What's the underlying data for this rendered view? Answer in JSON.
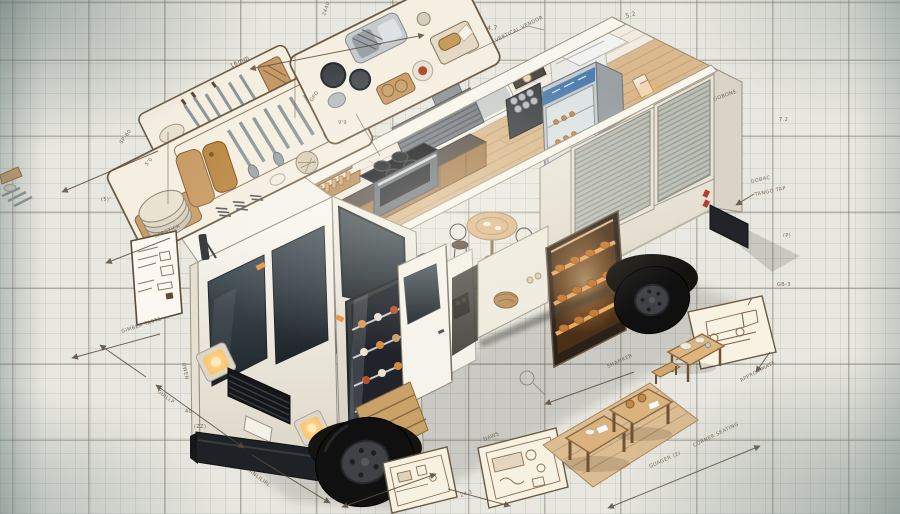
{
  "scene": {
    "subject": "Isometric cutaway concept illustration of a white food truck",
    "style": "technical blueprint sketch on grid paper",
    "parts": [
      "cab",
      "windshield",
      "headlights",
      "grille",
      "bumper",
      "wheels",
      "roll-up-shutter-doors",
      "serving-display",
      "open-door",
      "steps",
      "kitchen-stove",
      "vent-hood",
      "spice-rack",
      "espresso-machine",
      "sinks",
      "pans-tray",
      "display-fridge",
      "ice-chest",
      "bread-warmer",
      "round-table",
      "chairs",
      "stool",
      "utensil-trays",
      "appliance-tray",
      "floor-plan-sketches",
      "truck-sketch-card",
      "picnic-tables"
    ]
  },
  "palette": {
    "paper": "#e9e8e0",
    "grid_minor": "rgba(120,135,135,0.17)",
    "grid_major": "rgba(95,85,70,0.36)",
    "truck_white": "#f7f4ec",
    "glass_dark": "#2c363b",
    "wood_floor": "#d9b98d",
    "counter_wood": "#a87e50",
    "warm_glow": "#f0a45a",
    "fridge_band_blue": "#4f7fb0",
    "ink": "#6b5a44",
    "tire_black": "#101010"
  },
  "annotations": [
    {
      "text": "2440"
    },
    {
      "text": "16mm"
    },
    {
      "text": "SP-60"
    },
    {
      "text": "5'0"
    },
    {
      "text": "(5)'"
    },
    {
      "text": "4.7"
    },
    {
      "text": "VERTICAL VENDOR"
    },
    {
      "text": "5.2"
    },
    {
      "text": "GOBONE"
    },
    {
      "text": "7.2"
    },
    {
      "text": "GOBAC"
    },
    {
      "text": "TANGO TAP"
    },
    {
      "text": "(P)"
    },
    {
      "text": "GB-3"
    },
    {
      "text": "APPROXIMATE"
    },
    {
      "text": "CORNER SEATING"
    },
    {
      "text": "GUAGER (2)"
    },
    {
      "text": "SHAMKER"
    },
    {
      "text": "DAWS"
    },
    {
      "text": "24.1"
    },
    {
      "text": "ANLILIRL"
    },
    {
      "text": "GUILLP"
    },
    {
      "text": "OWEN"
    },
    {
      "text": "40"
    },
    {
      "text": "(ZZ)"
    },
    {
      "text": "SARSTICK"
    },
    {
      "text": "GIMBER TASTE"
    },
    {
      "text": "GPD"
    },
    {
      "text": "9'9"
    }
  ]
}
